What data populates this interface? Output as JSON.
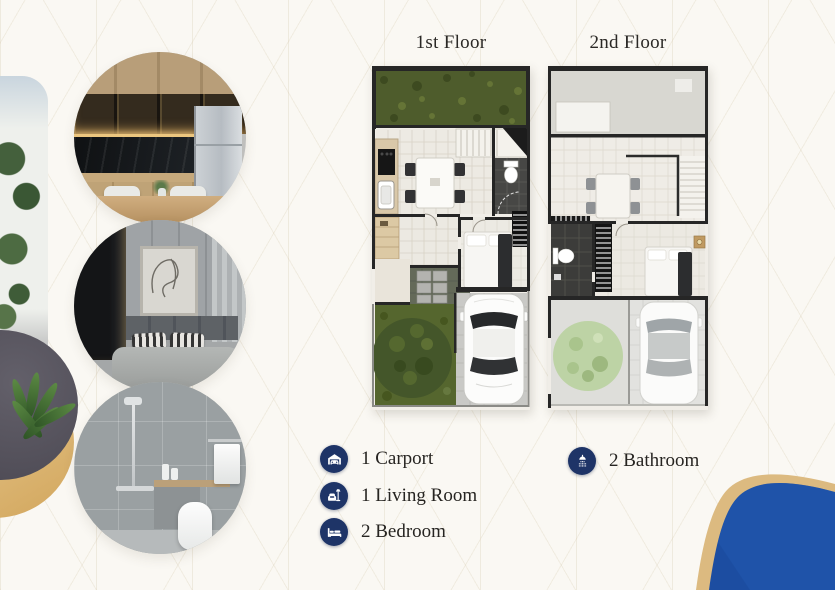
{
  "page": {
    "background": "#faf8f3",
    "pattern_line_color": "#e7e0d2",
    "accent_navy": "#1e3467",
    "text_color": "#262421",
    "ribbon_blue": "#1c4da1",
    "ribbon_gold": "#dcba80"
  },
  "floor_plans": [
    {
      "title": "1st Floor"
    },
    {
      "title": "2nd Floor"
    }
  ],
  "features": [
    {
      "icon": "carport-icon",
      "label": "1 Carport"
    },
    {
      "icon": "living-room-icon",
      "label": "1 Living Room"
    },
    {
      "icon": "bedroom-icon",
      "label": "2 Bedroom"
    },
    {
      "icon": "bathroom-icon",
      "label": "2 Bathroom"
    }
  ],
  "photos": [
    {
      "name": "kitchen-photo"
    },
    {
      "name": "bedroom-photo"
    },
    {
      "name": "bathroom-photo"
    },
    {
      "name": "plant-photo"
    },
    {
      "name": "exterior-photo"
    }
  ]
}
